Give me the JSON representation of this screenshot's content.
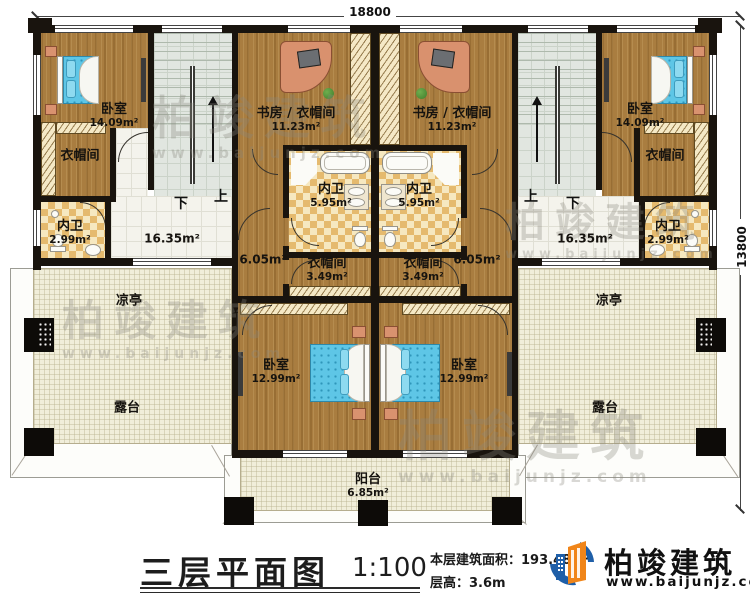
{
  "dimensions": {
    "top": "18800",
    "right": "13800"
  },
  "stairs": {
    "left": {
      "down": "下",
      "up": "上"
    },
    "right": {
      "up": "上",
      "down": "下"
    }
  },
  "rooms": {
    "bedroom_tl": {
      "name": "卧室",
      "area": "14.09m²"
    },
    "closet_tl": {
      "name": "衣帽间"
    },
    "bath_tl": {
      "name": "内卫",
      "area": "2.99m²"
    },
    "hall_l": {
      "area": "16.35m²"
    },
    "study_l": {
      "name": "书房 / 衣帽间",
      "area": "11.23m²"
    },
    "bath_ml": {
      "name": "内卫",
      "area": "5.95m²"
    },
    "closet_ml": {
      "name": "衣帽间",
      "area": "3.49m²"
    },
    "corridor_l": {
      "area": "6.05m²"
    },
    "bedroom_bl": {
      "name": "卧室",
      "area": "12.99m²"
    },
    "pavilion_l": {
      "name": "凉亭"
    },
    "terrace_l": {
      "name": "露台"
    },
    "bedroom_tr": {
      "name": "卧室",
      "area": "14.09m²"
    },
    "closet_tr": {
      "name": "衣帽间"
    },
    "bath_tr": {
      "name": "内卫",
      "area": "2.99m²"
    },
    "hall_r": {
      "area": "16.35m²"
    },
    "study_r": {
      "name": "书房 / 衣帽间",
      "area": "11.23m²"
    },
    "bath_mr": {
      "name": "内卫",
      "area": "5.95m²"
    },
    "closet_mr": {
      "name": "衣帽间",
      "area": "3.49m²"
    },
    "corridor_r": {
      "area": "6.05m²"
    },
    "bedroom_br": {
      "name": "卧室",
      "area": "12.99m²"
    },
    "pavilion_r": {
      "name": "凉亭"
    },
    "terrace_r": {
      "name": "露台"
    },
    "balcony": {
      "name": "阳台",
      "area": "6.85m²"
    }
  },
  "title": {
    "name": "三层平面图",
    "scale": "1:100",
    "area_label": "本层建筑面积：193.48m²",
    "height_label": "层高：3.6m"
  },
  "watermark": {
    "brand": "柏竣建筑",
    "url": "www.baijunjz.com"
  },
  "logo": {
    "brand": "柏竣建筑",
    "url": "www.baijunjz.com"
  },
  "colors": {
    "wall": "#19140e",
    "wood": "#a97d40",
    "checker_tile": "#e5ba6e",
    "terrace": "#f1eeda",
    "stair_tile": "#e1e6e0",
    "bed": "#5ec6e6",
    "logo_blue": "#1f5fa8",
    "logo_orange": "#f08519"
  }
}
